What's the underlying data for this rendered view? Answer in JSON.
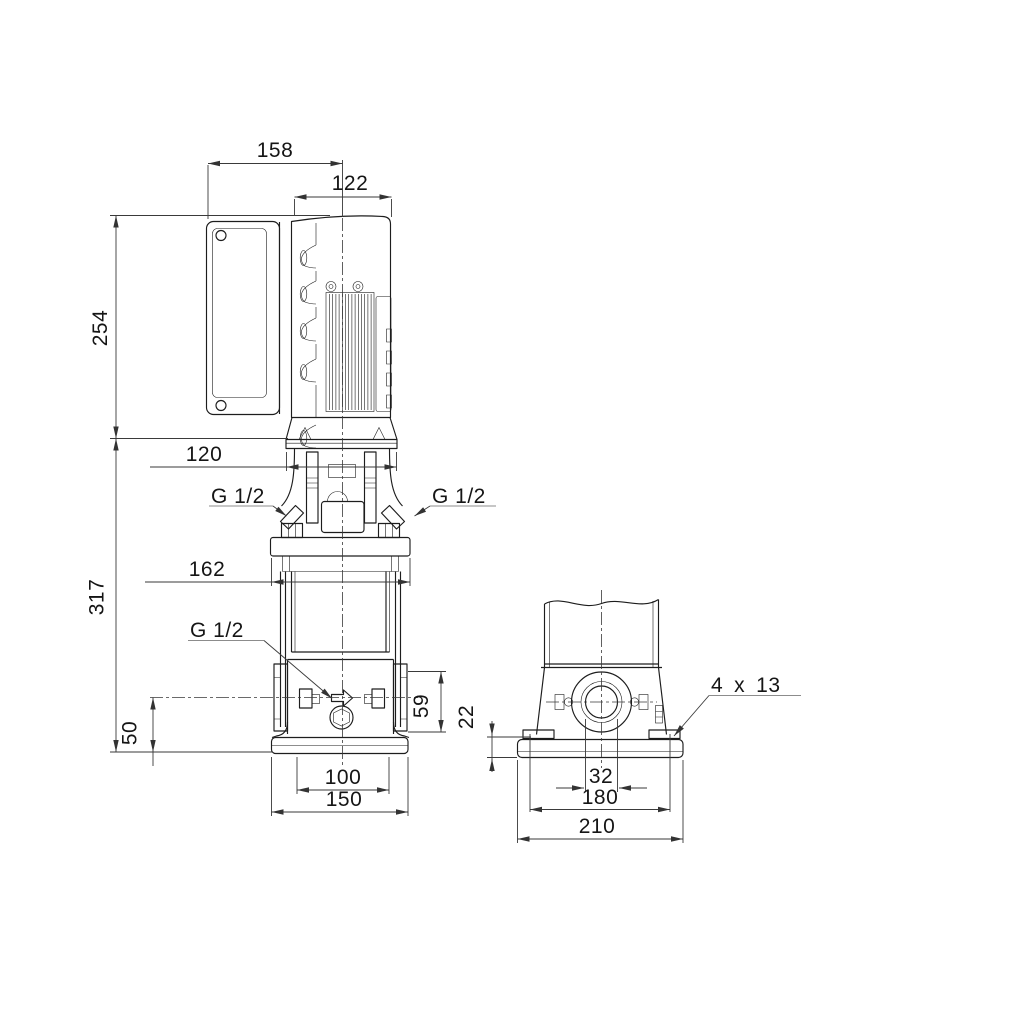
{
  "drawing": {
    "type": "pump-dimensional-drawing",
    "colors": {
      "line": "#1d1d1d",
      "dimension": "#3a3a3a",
      "leader": "#8c8c8c",
      "background": "#ffffff"
    },
    "side_view": {
      "dims": {
        "overall_width": "158",
        "motor_diameter": "122",
        "motor_height": "254",
        "coupling_width": "120",
        "pump_height": "317",
        "head_flange_width": "162",
        "port_center_height": "50",
        "port_boss_height": "59",
        "foot_width": "100",
        "base_width": "150"
      },
      "labels": {
        "gauge_port_left": "G 1/2",
        "gauge_port_right": "G 1/2",
        "drain_port": "G 1/2"
      }
    },
    "front_view": {
      "dims": {
        "base_plate_thickness": "22",
        "port_bore": "32",
        "bolt_spacing": "180",
        "base_width": "210"
      },
      "labels": {
        "bolt_holes": "4 x 13"
      }
    }
  }
}
